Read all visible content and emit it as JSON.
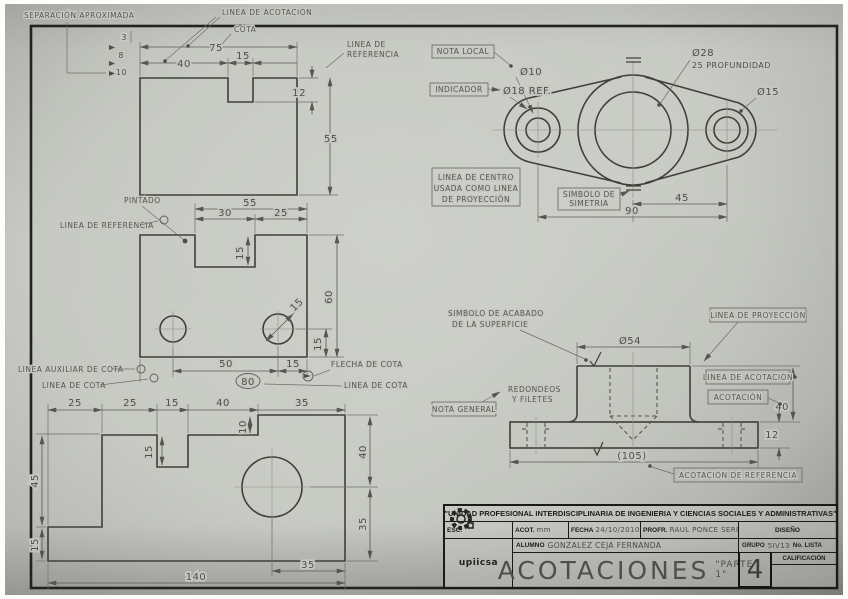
{
  "labels": {
    "separacion": "SEPARACIÓN APROXIMADA",
    "linea_acotacion": "LINEA DE ACOTACIÓN",
    "cota": "COTA",
    "linea_referencia_1": "LINEA DE",
    "linea_referencia_2": "REFERENCIA",
    "nota_local": "NOTA LOCAL",
    "indicador": "INDICADOR",
    "linea_centro_1": "LINEA DE CENTRO",
    "linea_centro_2": "USADA COMO LINEA",
    "linea_centro_3": "DE PROYECCIÓN",
    "simbolo_simetria_1": "SIMBOLO DE",
    "simbolo_simetria_2": "SIMETRIA",
    "pintado": "PINTADO",
    "linea_referencia2": "LINEA DE REFERENCIA",
    "linea_auxiliar": "LINEA AUXILIAR DE COTA",
    "linea_cota": "LINEA DE COTA",
    "flecha_cota": "FLECHA DE COTA",
    "linea_cota2": "LINEA DE COTA",
    "simbolo_acabado_1": "SIMBOLO DE ACABADO",
    "simbolo_acabado_2": "DE LA SUPERFICIE",
    "linea_proyeccion": "LINEA DE PROYECCIÓN",
    "linea_acotacion2": "LINEA DE ACOTACIÓN",
    "acotacion": "ACOTACIÓN",
    "redondeos_1": "REDONDEOS",
    "redondeos_2": "Y FILETES",
    "nota_general": "NOTA GENERAL",
    "acotacion_ref": "ACOTACIÓN DE REFERENCIA"
  },
  "view1": {
    "d75": "75",
    "d40": "40",
    "d15": "15",
    "d12": "12",
    "d55": "55",
    "s3": "3",
    "s8": "8",
    "s10": "10"
  },
  "view2": {
    "d55": "55",
    "d30": "30",
    "d25": "25",
    "d15notch": "15",
    "d60": "60",
    "d15r": "15",
    "dia15": "15",
    "d50": "50",
    "d15b": "15",
    "d80": "80"
  },
  "view3": {
    "t25a": "25",
    "t25b": "25",
    "t15": "15",
    "t40": "40",
    "t35": "35",
    "d10": "10",
    "n15": "15",
    "l45": "45",
    "l15": "15",
    "r40": "40",
    "r35": "35",
    "b35": "35",
    "b140": "140"
  },
  "view4": {
    "dia10": "Ø10",
    "dia18": "Ø18 REF.",
    "dia28": "Ø28",
    "prof": "25 PROFUNDIDAD",
    "dia15": "Ø15",
    "d45": "45",
    "d90": "90"
  },
  "view5": {
    "dia54": "Ø54",
    "d40": "40",
    "d12": "12",
    "d105": "(105)"
  },
  "titleblock": {
    "institution": "\"UNIDAD PROFESIONAL INTERDISCIPLINARIA DE INGENIERIA Y CIENCIAS SOCIALES Y ADMINISTRATIVAS\"",
    "esc_label": "ESC.",
    "acot_label": "ACOT.",
    "acot_value": "mm",
    "fecha_label": "FECHA",
    "fecha_value": "24/10/2010",
    "profr_label": "PROFR.",
    "profr_value": "RAUL PONCE SERRIN",
    "diseno_label": "DISEÑO",
    "alumno_label": "ALUMNO",
    "alumno_value": "GONZALEZ CEJA FERNANDA",
    "grupo_label": "GRUPO",
    "grupo_value": "5IV13",
    "lista_label": "No. LISTA",
    "calificacion_label": "CALIFICACIÓN",
    "title_main": "ACOTACIONES",
    "title_sub": "\"PARTE 1\"",
    "sheet_number": "4",
    "logo_text": "upiicsa"
  }
}
